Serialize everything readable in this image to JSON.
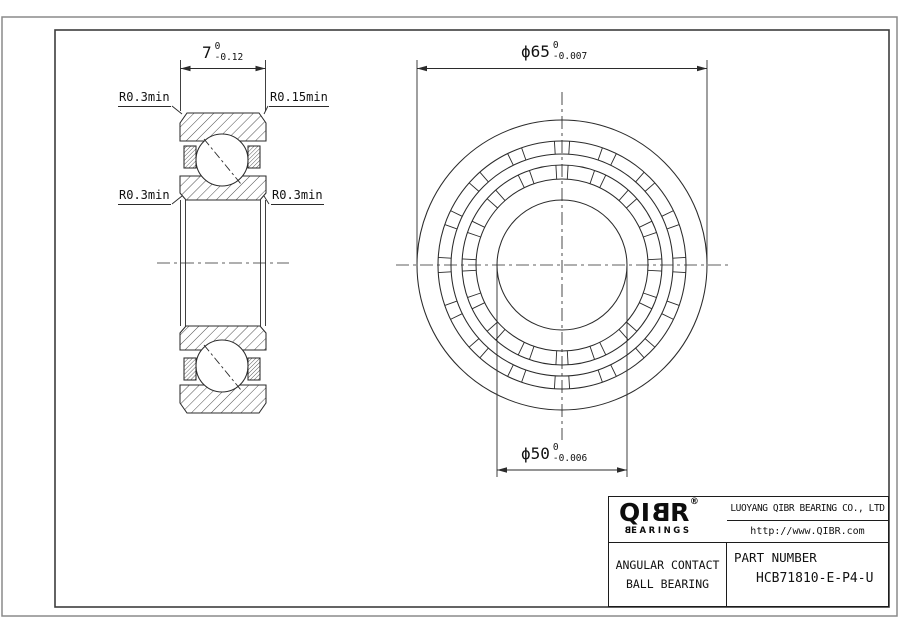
{
  "drawing": {
    "dimensions": {
      "width": {
        "nominal": "7",
        "tol_upper": "0",
        "tol_lower": "-0.12"
      },
      "outer_diameter": {
        "nominal": "ϕ65",
        "tol_upper": "0",
        "tol_lower": "-0.007"
      },
      "bore_diameter": {
        "nominal": "ϕ50",
        "tol_upper": "0",
        "tol_lower": "-0.006"
      }
    },
    "radius_labels": {
      "top_left": "R0.3min",
      "top_right": "R0.15min",
      "bottom_left": "R0.3min",
      "bottom_right": "R0.3min"
    }
  },
  "title_block": {
    "logo": {
      "parts": [
        "Q",
        "I",
        "B",
        "R"
      ],
      "registered": "®",
      "sub_parts": [
        "B",
        "EARINGS"
      ]
    },
    "company": "LUOYANG QIBR BEARING CO., LTD",
    "website": "http://www.QIBR.com",
    "product_type_line1": "ANGULAR CONTACT",
    "product_type_line2": "BALL BEARING",
    "part_number_label": "PART NUMBER",
    "part_number": "HCB71810-E-P4-U"
  },
  "colors": {
    "line": "#2b2b2b",
    "text": "#111111",
    "frame": "#3d3d3d",
    "page_border": "#8a8a8a",
    "background": "#ffffff"
  }
}
